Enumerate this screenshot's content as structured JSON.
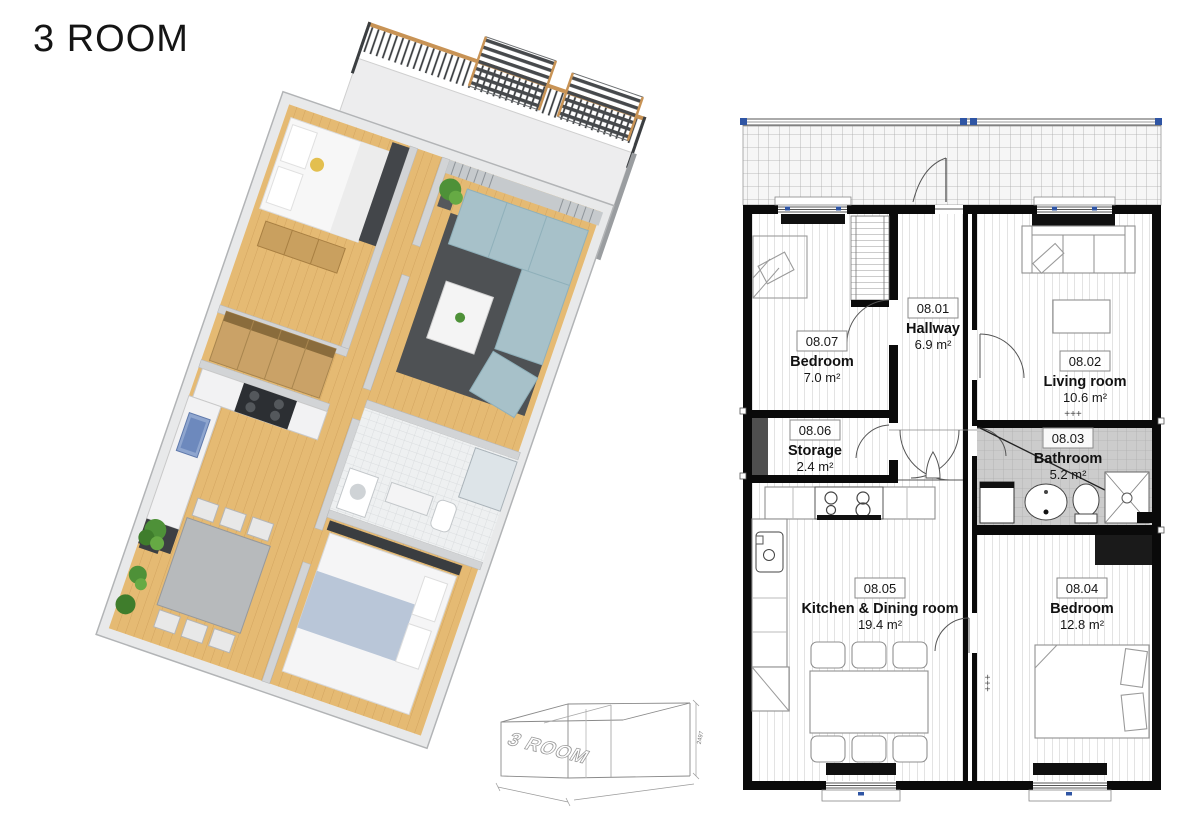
{
  "page": {
    "title": "3 ROOM"
  },
  "plan_2d": {
    "rooms": {
      "hallway": {
        "code": "08.01",
        "name": "Hallway",
        "area": "6.9 m²"
      },
      "bedroom_top": {
        "code": "08.07",
        "name": "Bedroom",
        "area": "7.0 m²"
      },
      "living": {
        "code": "08.02",
        "name": "Living room",
        "area": "10.6 m²"
      },
      "storage": {
        "code": "08.06",
        "name": "Storage",
        "area": "2.4 m²"
      },
      "bathroom": {
        "code": "08.03",
        "name": "Bathroom",
        "area": "5.2 m²"
      },
      "kitchen": {
        "code": "08.05",
        "name": "Kitchen & Dining room",
        "area": "19.4 m²"
      },
      "bedroom_bottom": {
        "code": "08.04",
        "name": "Bedroom",
        "area": "12.8 m²"
      }
    },
    "radiator_marks": "+++"
  },
  "wireframe": {
    "label": "3 ROOM",
    "height_dimension": "2497"
  },
  "colors": {
    "wall_black": "#0a0a0a",
    "bathroom_tile": "#cccccc",
    "selection_handle_blue": "#2f55a4",
    "wood_floor": "#e5ba73",
    "sofa_blue": "#a7c1c9",
    "rug_gray": "#4e5154",
    "plant_green": "#4e9138",
    "rail_wood": "#c89355"
  }
}
